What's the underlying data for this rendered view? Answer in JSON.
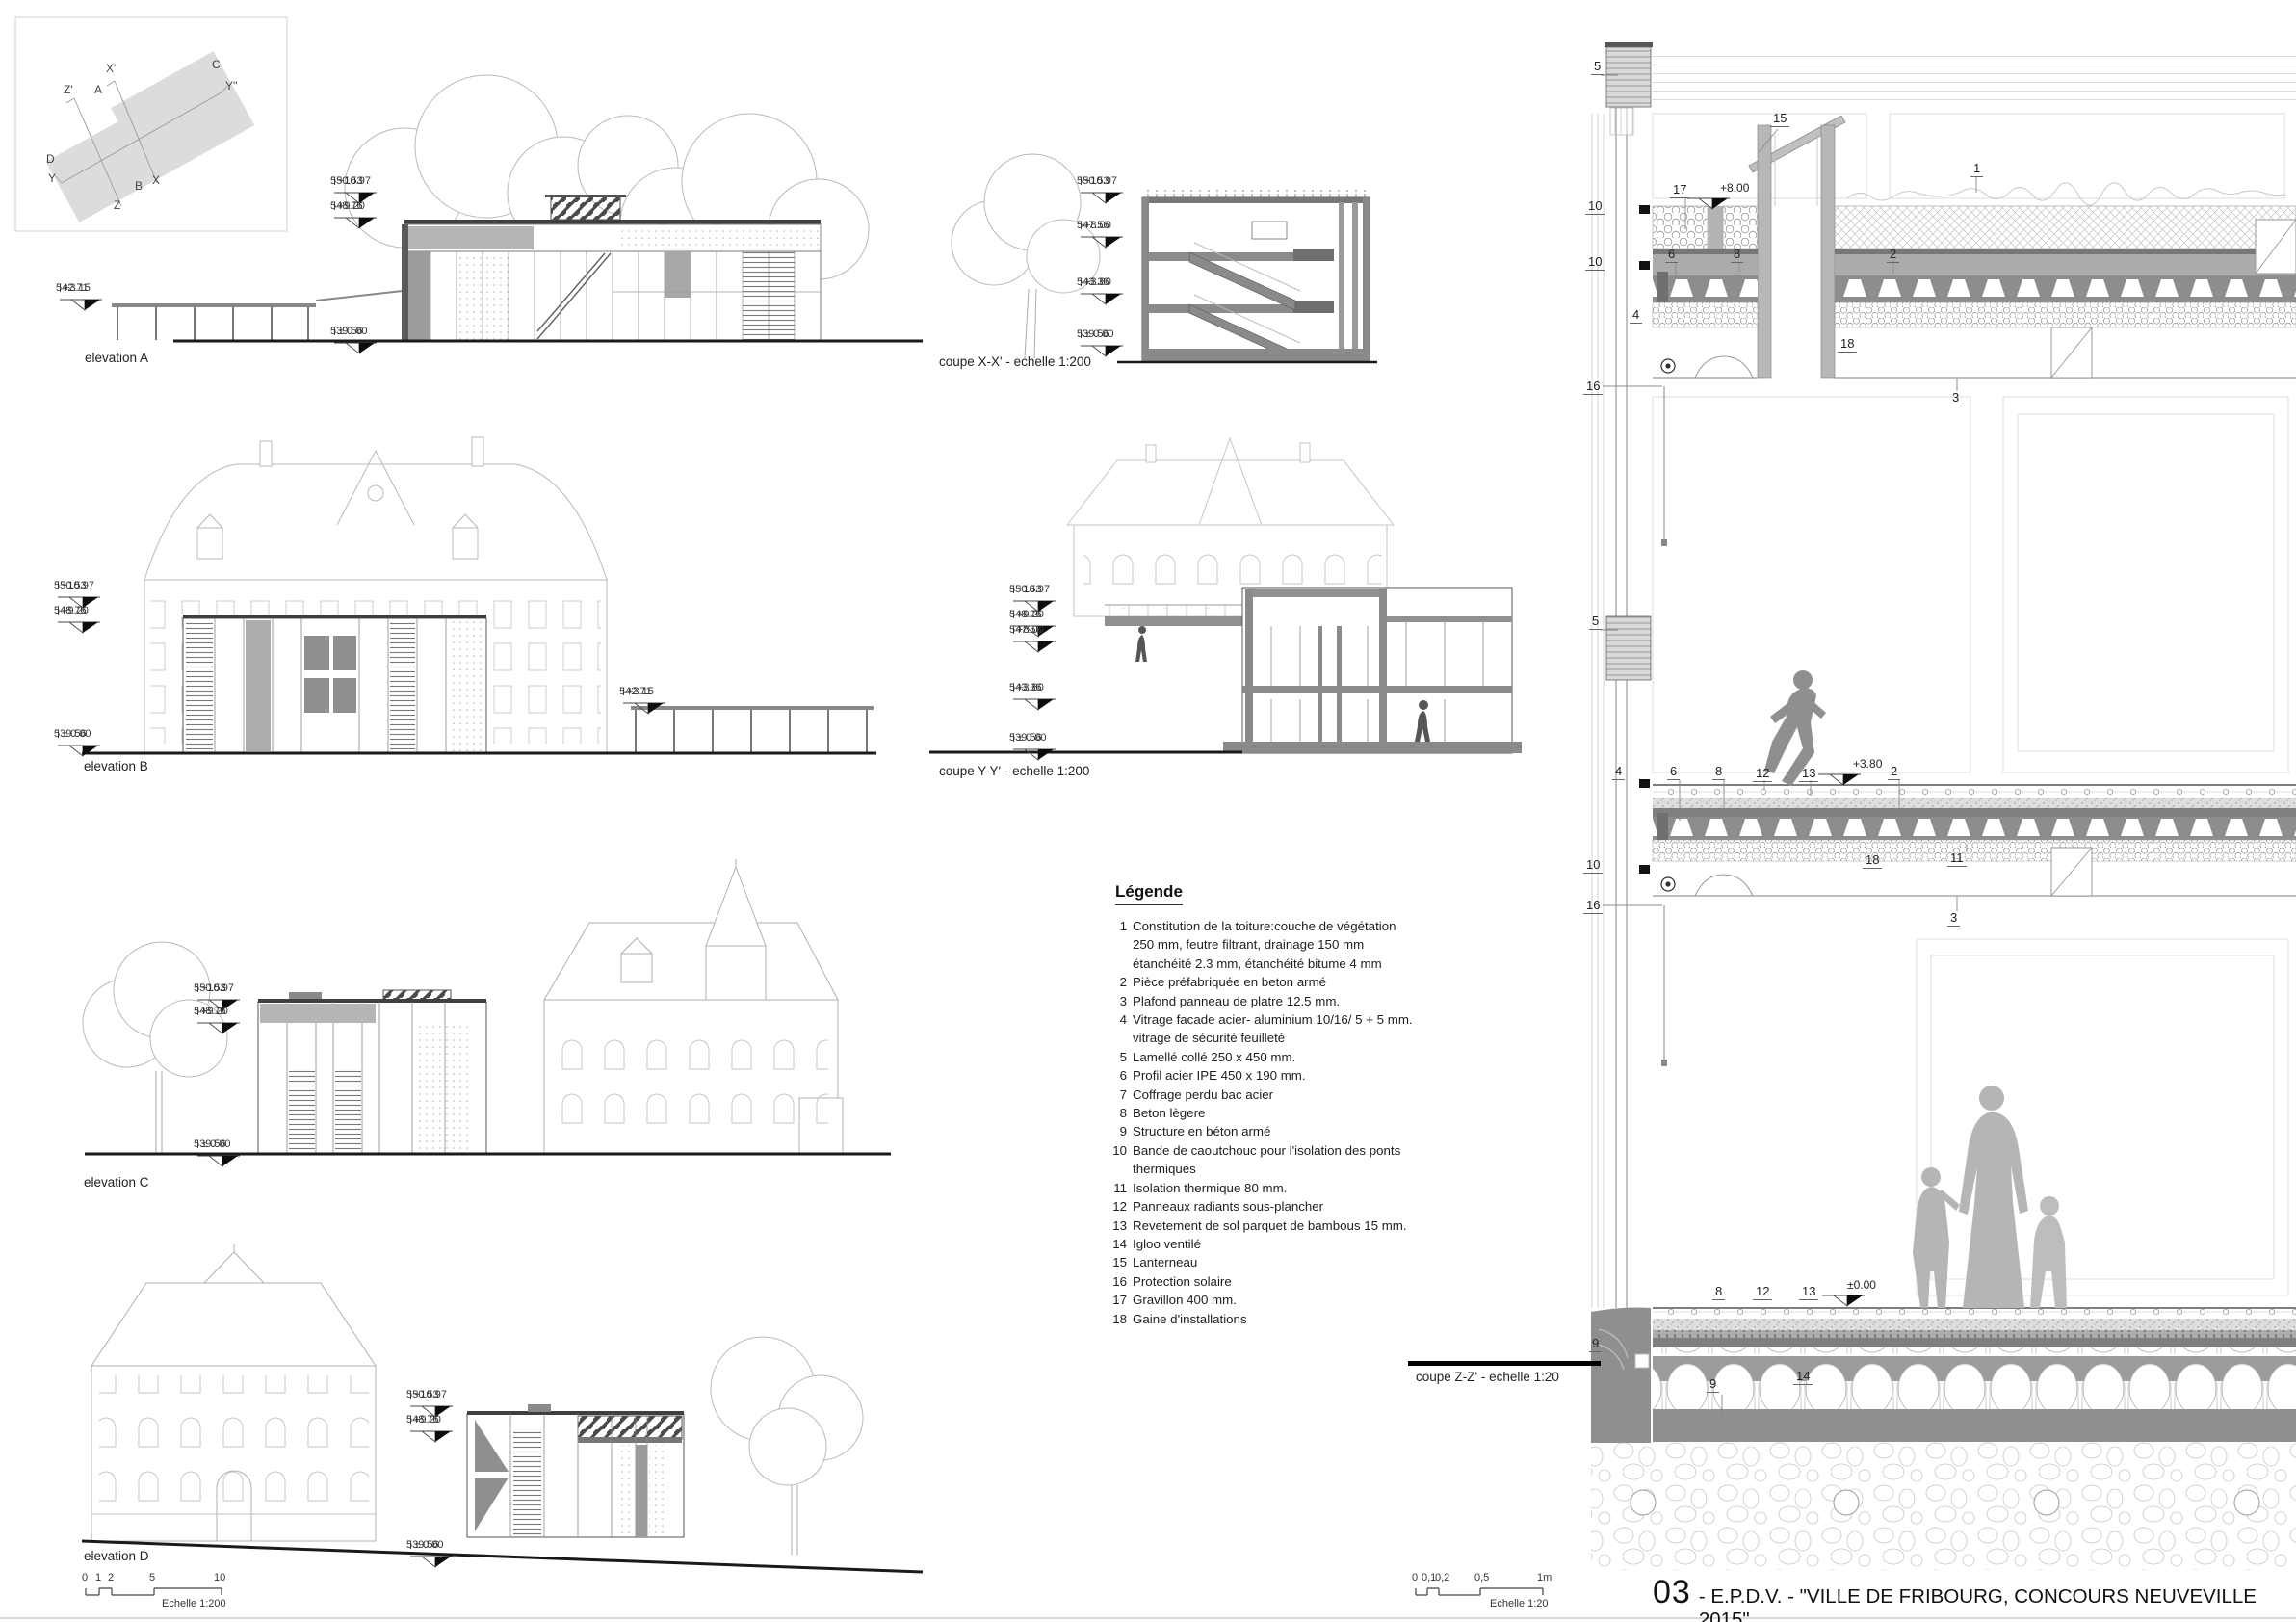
{
  "title": {
    "number": "03",
    "text": "- E.P.D.V. - \"VILLE DE FRIBOURG, CONCOURS NEUVEVILLE 2015\""
  },
  "keyplan": {
    "x_prime": "X'",
    "c": "C",
    "y_dprime": "Y''",
    "z_prime": "Z'",
    "a": "A",
    "d": "D",
    "y": "Y",
    "b": "B",
    "z": "Z",
    "x": "X"
  },
  "captions": {
    "a": "elevation A",
    "b": "elevation B",
    "c": "elevation C",
    "d": "elevation D",
    "x": "coupe X-X' - echelle 1:200",
    "y": "coupe Y-Y' - echelle 1:200",
    "z": "coupe Z-Z' - echelle 1:20"
  },
  "markers": {
    "a": [
      {
        "alt": "550.53",
        "rel": "+10.97"
      },
      {
        "alt": "548.76",
        "rel": "+9.20"
      },
      {
        "alt": "542.71",
        "rel": "+3.15"
      },
      {
        "alt": "539.56",
        "rel": "± 0.00"
      }
    ],
    "b": [
      {
        "alt": "550.53",
        "rel": "+10.97"
      },
      {
        "alt": "548.76",
        "rel": "+9.20"
      },
      {
        "alt": "539.56",
        "rel": "± 0.00"
      },
      {
        "alt": "542.71",
        "rel": "+3.15"
      }
    ],
    "c": [
      {
        "alt": "550.53",
        "rel": "+10.97"
      },
      {
        "alt": "548.76",
        "rel": "+9.20"
      },
      {
        "alt": "539.56",
        "rel": "± 0.00"
      }
    ],
    "d": [
      {
        "alt": "550.53",
        "rel": "+10.97"
      },
      {
        "alt": "548.76",
        "rel": "+9.20"
      },
      {
        "alt": "539.56",
        "rel": "± 0.00"
      }
    ],
    "x": [
      {
        "alt": "550.53",
        "rel": "+10.97"
      },
      {
        "alt": "547.56",
        "rel": "+8.00"
      },
      {
        "alt": "543.36",
        "rel": "+3.80"
      },
      {
        "alt": "539.56",
        "rel": "± 0.00"
      }
    ],
    "y": [
      {
        "alt": "550.53",
        "rel": "+10.97"
      },
      {
        "alt": "548.76",
        "rel": "+9.20"
      },
      {
        "alt": "547.56",
        "rel": "+8.00"
      },
      {
        "alt": "543.36",
        "rel": "+3.80"
      },
      {
        "alt": "539.56",
        "rel": "± 0.00"
      }
    ]
  },
  "legend": {
    "title": "Légende",
    "items": [
      {
        "num": "1",
        "text": "Constitution de la toiture:couche de végétation"
      },
      {
        "num": "",
        "text": "250 mm, feutre filtrant, drainage 150 mm"
      },
      {
        "num": "",
        "text": "étanchéité 2.3 mm,  étanchéité bitume 4 mm"
      },
      {
        "num": "2",
        "text": "Pièce préfabriquée en beton armé"
      },
      {
        "num": "3",
        "text": "Plafond panneau de platre 12.5 mm."
      },
      {
        "num": "4",
        "text": "Vitrage facade acier- aluminium 10/16/ 5 + 5 mm."
      },
      {
        "num": "",
        "text": "vitrage de sécurité feuilleté"
      },
      {
        "num": "5",
        "text": "Lamellé collé 250 x 450 mm."
      },
      {
        "num": "6",
        "text": "Profil acier IPE 450 x 190 mm."
      },
      {
        "num": "7",
        "text": "Coffrage perdu bac acier"
      },
      {
        "num": "8",
        "text": "Beton lègere"
      },
      {
        "num": "9",
        "text": "Structure en béton armé"
      },
      {
        "num": "10",
        "text": "Bande de caoutchouc pour l'isolation des ponts thermiques"
      },
      {
        "num": "11",
        "text": "Isolation thermique 80 mm."
      },
      {
        "num": "12",
        "text": "Panneaux radiants sous-plancher"
      },
      {
        "num": "13",
        "text": "Revetement de sol parquet de bambous 15 mm."
      },
      {
        "num": "14",
        "text": "Igloo ventilé"
      },
      {
        "num": "15",
        "text": "Lanterneau"
      },
      {
        "num": "16",
        "text": "Protection solaire"
      },
      {
        "num": "17",
        "text": "Gravillon 400 mm."
      },
      {
        "num": "18",
        "text": "Gaine d'installations"
      }
    ]
  },
  "detail_callouts": [
    "5",
    "10",
    "10",
    "4",
    "16",
    "15",
    "17",
    "1",
    "6",
    "8",
    "2",
    "18",
    "3",
    "5",
    "4",
    "6",
    "8",
    "12",
    "13",
    "2",
    "10",
    "16",
    "18",
    "11",
    "3",
    "8",
    "12",
    "13",
    "9",
    "9",
    "14"
  ],
  "detail_levels": [
    "+8.00",
    "+3.80",
    "±0.00"
  ],
  "scalebar200": {
    "ticks": [
      "0",
      "1",
      "2",
      "5",
      "10"
    ],
    "label": "Echelle 1:200"
  },
  "scalebar20": {
    "ticks": [
      "0",
      "0,1",
      "0,2",
      "0,5",
      "1m"
    ],
    "label": "Echelle 1:20"
  }
}
